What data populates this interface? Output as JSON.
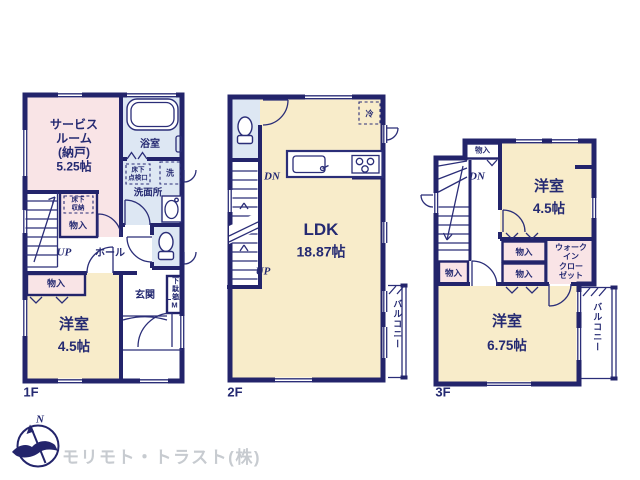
{
  "colors": {
    "wall_navy": "#23246b",
    "room_yellow": "#f8ecca",
    "room_pink": "#f9e4e6",
    "room_blue": "#dde7f3",
    "muted_gray": "#c7cbd0"
  },
  "floor1": {
    "label": "1F",
    "service_room": "サービス\nルーム\n(納戸)\n5.25帖",
    "bath": "浴室",
    "laundry": "洗",
    "washroom": "洗面所",
    "inspection_hatch": "床下\n点検口",
    "floor_storage": "床下\n収納",
    "storage_hall": "物入",
    "up": "UP",
    "hall": "ホール",
    "storage_bedroom": "物入",
    "bedroom_name": "洋室",
    "bedroom_size": "4.5帖",
    "entrance": "玄関",
    "shoe_cabinet": "下駄箱",
    "shoe_cabinet_m": "M"
  },
  "floor2": {
    "label": "2F",
    "dn": "DN",
    "up": "UP",
    "fridge": "冷",
    "ldk_name": "LDK",
    "ldk_size": "18.87帖",
    "balcony": "バルコニー"
  },
  "floor3": {
    "label": "3F",
    "storage_top": "物入",
    "dn": "DN",
    "bedroom1_name": "洋室",
    "bedroom1_size": "4.5帖",
    "storage_a": "物入",
    "storage_b": "物入",
    "storage_left": "物入",
    "wic": "ウォーク\nイン\nクロー\nゼット",
    "bedroom2_name": "洋室",
    "bedroom2_size": "6.75帖",
    "balcony": "バルコニー"
  },
  "footer": {
    "north_label": "N",
    "company": "モリモト・トラスト(株)"
  }
}
